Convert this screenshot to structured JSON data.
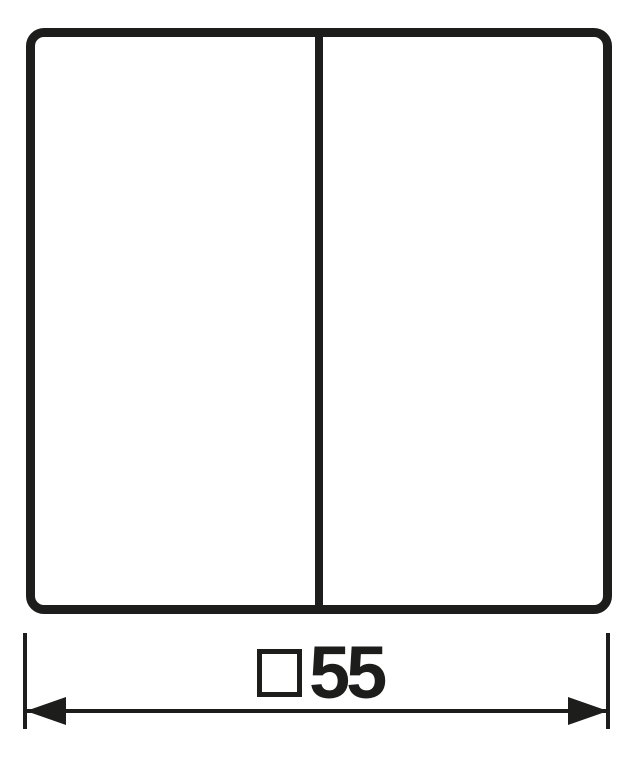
{
  "colors": {
    "line": "#1d1d1b",
    "background": "#ffffff"
  },
  "plate": {
    "sections": 2
  },
  "dimension": {
    "symbol": "□",
    "value": "55"
  }
}
